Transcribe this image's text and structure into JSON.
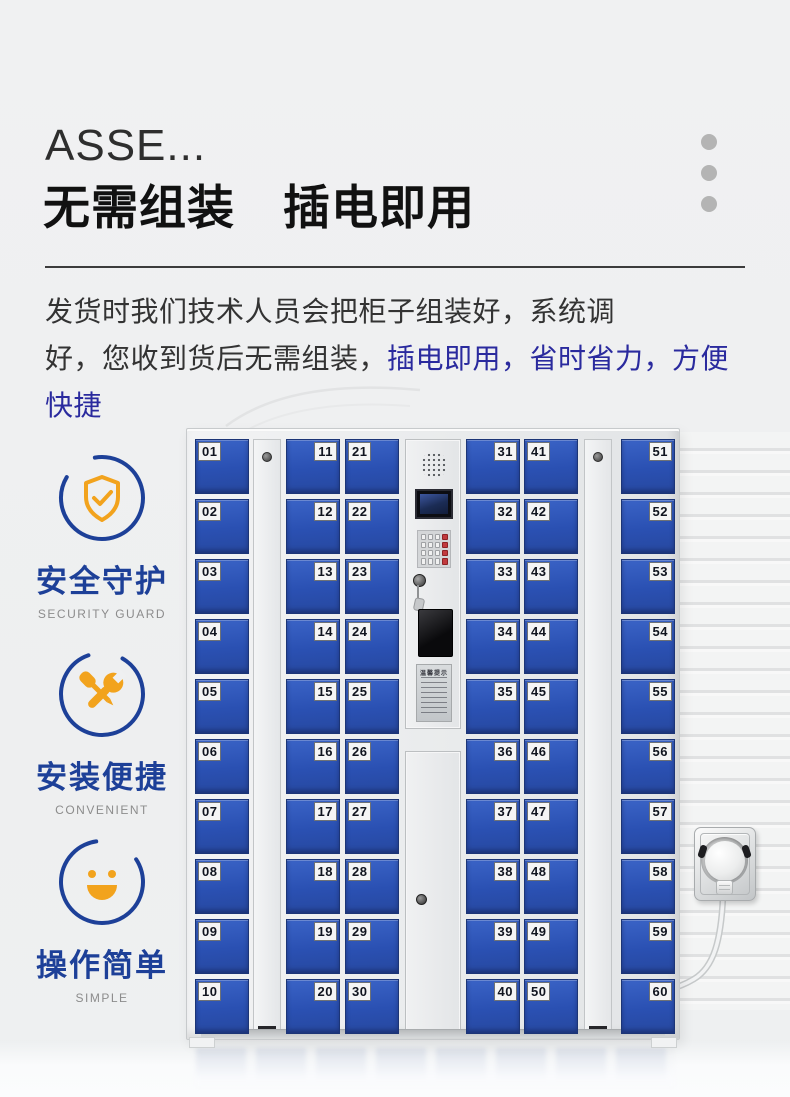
{
  "header": {
    "title": "ASSE...",
    "heading": "无需组装　插电即用"
  },
  "intro": {
    "line1": "发货时我们技术人员会把柜子组装好，系统调",
    "line2_black": "好，您收到货后无需组装，",
    "line2_highlight": "插电即用，省时省力，方便快捷"
  },
  "features": [
    {
      "icon": "shield-check-icon",
      "title": "安全守护",
      "subtitle": "SECURITY GUARD"
    },
    {
      "icon": "tools-icon",
      "title": "安装便捷",
      "subtitle": "CONVENIENT"
    },
    {
      "icon": "smiley-icon",
      "title": "操作简单",
      "subtitle": "SIMPLE"
    }
  ],
  "locker": {
    "columns": [
      {
        "side": "left",
        "numbers": [
          "01",
          "02",
          "03",
          "04",
          "05",
          "06",
          "07",
          "08",
          "09",
          "10"
        ]
      },
      {
        "side": "right",
        "numbers": [
          "11",
          "12",
          "13",
          "14",
          "15",
          "16",
          "17",
          "18",
          "19",
          "20"
        ]
      },
      {
        "side": "left",
        "numbers": [
          "21",
          "22",
          "23",
          "24",
          "25",
          "26",
          "27",
          "28",
          "29",
          "30"
        ]
      },
      {
        "side": "right",
        "numbers": [
          "31",
          "32",
          "33",
          "34",
          "35",
          "36",
          "37",
          "38",
          "39",
          "40"
        ]
      },
      {
        "side": "left",
        "numbers": [
          "41",
          "42",
          "43",
          "44",
          "45",
          "46",
          "47",
          "48",
          "49",
          "50"
        ]
      },
      {
        "side": "right",
        "numbers": [
          "51",
          "52",
          "53",
          "54",
          "55",
          "56",
          "57",
          "58",
          "59",
          "60"
        ]
      }
    ],
    "panel": {
      "notice_title": "温馨提示"
    }
  },
  "colors": {
    "page_bg": "#eff0f1",
    "accent_blue": "#1d4098",
    "accent_orange": "#f2a31d",
    "door_blue": "#2b52b7",
    "highlight_text": "#2a2a9e",
    "dot_gray": "#b4b4b4"
  }
}
